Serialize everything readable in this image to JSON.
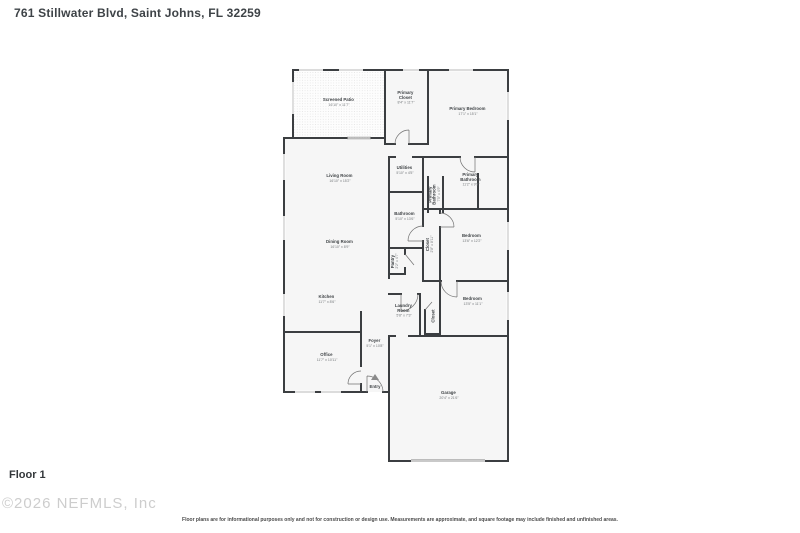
{
  "header": {
    "address": "761 Stillwater Blvd, Saint Johns, FL 32259"
  },
  "footer": {
    "floor_label": "Floor 1",
    "watermark": "©2026 NEFMLS, Inc",
    "disclaimer": "Floor plans are for informational purposes only and not for construction or design use. Measurements are approximate, and square footage may include finished and unfinished areas."
  },
  "floorplan": {
    "colors": {
      "wall": "#3b3e41",
      "room_fill": "#f6f6f6",
      "window": "#b8b8b8",
      "door": "#707070",
      "label": "#3f4346"
    },
    "rooms": {
      "screened_patio": {
        "name": "Screened Patio",
        "dims": "16'10\" x 11'7\""
      },
      "primary_closet": {
        "line1": "Primary",
        "line2": "Closet",
        "dims": "8'4\" x 11'7\""
      },
      "primary_bedroom": {
        "name": "Primary Bedroom",
        "dims": "17'1\" x 15'1\""
      },
      "living_room": {
        "name": "Living Room",
        "dims": "16'10\" x 15'2\""
      },
      "utilities": {
        "name": "Utilities",
        "dims": "5'10\" x 4'5\""
      },
      "primary_bathroom_wc": {
        "line1": "Primary",
        "line2": "Bathroom",
        "dims": "7'5\" x 4'9\""
      },
      "primary_bathroom": {
        "line1": "Primary",
        "line2": "Bathroom",
        "dims": "11'2\" x 9'9\""
      },
      "bathroom": {
        "name": "Bathroom",
        "dims": "5'10\" x 13'6\""
      },
      "hall_closet": {
        "name": "Closet",
        "dims": "2'8\" x 8'11\""
      },
      "bedroom_1": {
        "name": "Bedroom",
        "dims": "13'6\" x 12'2\""
      },
      "dining_room": {
        "name": "Dining Room",
        "dims": "16'10\" x 8'9\""
      },
      "pantry": {
        "name": "Pantry",
        "dims": "2'2\" x 4'7\""
      },
      "kitchen": {
        "name": "Kitchen",
        "dims": "11'7\" x 8'6\""
      },
      "laundry_room": {
        "line1": "Laundry",
        "line2": "Room",
        "dims": "5'8\" x 7'3\""
      },
      "laundry_closet": {
        "name": "Closet"
      },
      "bedroom_2": {
        "name": "Bedroom",
        "dims": "13'5\" x 11'1\""
      },
      "foyer": {
        "name": "Foyer",
        "dims": "5'1\" x 10'8\""
      },
      "office": {
        "name": "Office",
        "dims": "11'7\" x 10'11\""
      },
      "entry": {
        "name": "Entry"
      },
      "garage": {
        "name": "Garage",
        "dims": "20'4\" x 21'6\""
      }
    }
  }
}
